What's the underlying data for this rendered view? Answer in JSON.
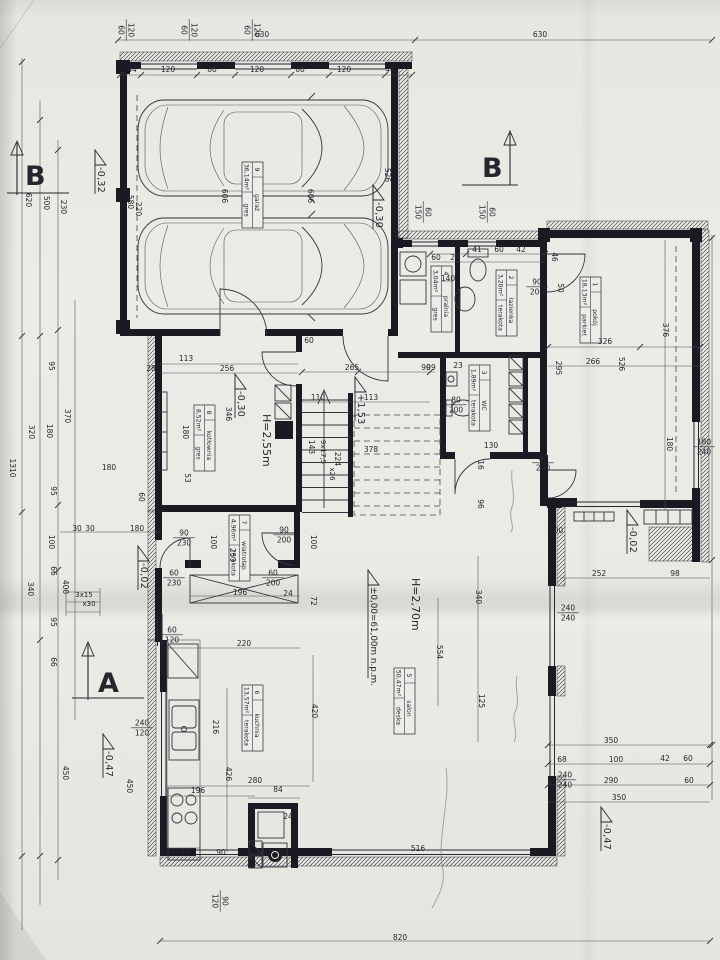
{
  "palette": {
    "paper": "#eae9e4",
    "ink": "#22222a",
    "thin_line": "#4c4c55"
  },
  "plan": {
    "heights": [
      [
        "H=2,55m",
        263,
        414
      ],
      [
        "H=2,70m",
        412,
        578
      ]
    ],
    "levels": [
      [
        "-0,32",
        96,
        150
      ],
      [
        "-0,30",
        374,
        185
      ],
      [
        "-0,30",
        236,
        374
      ],
      [
        "+1,53",
        356,
        377
      ],
      [
        "±0,00=61,00m n.p.m.",
        369,
        570
      ],
      [
        "-0,02",
        628,
        510
      ],
      [
        "-0,02",
        139,
        546
      ],
      [
        "-0,47",
        602,
        807
      ],
      [
        "-0,47",
        104,
        734
      ]
    ],
    "sections": [
      {
        "letter": "B",
        "x": 25,
        "y": 185,
        "v": 0
      },
      {
        "letter": "B",
        "x": 482,
        "y": 177,
        "v": 1
      },
      {
        "letter": "A",
        "x": 98,
        "y": 692,
        "v": 2
      }
    ],
    "stair_notes": [
      [
        "9x17,5",
        321,
        452,
        1
      ],
      [
        "x26",
        330,
        474,
        1
      ],
      [
        "3x15",
        84,
        597,
        0
      ],
      [
        "x30",
        89,
        606,
        0
      ]
    ]
  },
  "rooms": [
    {
      "no": "1",
      "name": "pokój",
      "area": "18,13m²",
      "floor": "parkiet",
      "x": 601,
      "y": 277
    },
    {
      "no": "2",
      "name": "łazienka",
      "area": "3,20m²",
      "floor": "terakota",
      "x": 517,
      "y": 270
    },
    {
      "no": "3",
      "name": "WC",
      "area": "1,89m²",
      "floor": "terakota",
      "x": 490,
      "y": 365
    },
    {
      "no": "4",
      "name": "pralnia",
      "area": "3,04m²",
      "floor": "gres",
      "x": 452,
      "y": 266
    },
    {
      "no": "5",
      "name": "salon",
      "area": "50,47m²",
      "floor": "deska",
      "x": 415,
      "y": 668
    },
    {
      "no": "6",
      "name": "kuchnia",
      "area": "13,57m²",
      "floor": "terakota",
      "x": 263,
      "y": 685
    },
    {
      "no": "7",
      "name": "wiatrołap",
      "area": "4,96m²",
      "floor": "terakota",
      "x": 250,
      "y": 515
    },
    {
      "no": "8",
      "name": "kotłownia",
      "area": "8,52m²",
      "floor": "gres",
      "x": 215,
      "y": 405
    },
    {
      "no": "9",
      "name": "garaż",
      "area": "36,14m²",
      "floor": "gres",
      "x": 263,
      "y": 162
    }
  ],
  "opening_labels": [
    [
      "120/60",
      127,
      30,
      1
    ],
    [
      "120/60",
      190,
      30,
      1
    ],
    [
      "120/60",
      253,
      30,
      1
    ],
    [
      "60/150",
      424,
      212,
      1
    ],
    [
      "60/150",
      488,
      212,
      1
    ],
    [
      "180/240",
      704,
      446,
      0
    ],
    [
      "240/240",
      568,
      612,
      0
    ],
    [
      "240/240",
      565,
      779,
      0
    ],
    [
      "240/120",
      142,
      727,
      0
    ],
    [
      "60/120",
      172,
      634,
      0
    ],
    [
      "90/120",
      221,
      901,
      1
    ],
    [
      "90/200",
      537,
      286,
      0
    ],
    [
      "90/230",
      184,
      537,
      0
    ],
    [
      "90/200",
      284,
      534,
      0
    ],
    [
      "60/230",
      174,
      577,
      0
    ],
    [
      "60/200",
      273,
      577,
      0
    ],
    [
      "80/200",
      456,
      404,
      0
    ],
    [
      "80/200",
      543,
      462,
      0
    ]
  ],
  "dims": [
    [
      "630",
      262,
      37,
      0
    ],
    [
      "630",
      540,
      37,
      0
    ],
    [
      "44",
      132,
      72,
      0
    ],
    [
      "120",
      168,
      72,
      0
    ],
    [
      "80",
      212,
      72,
      0
    ],
    [
      "120",
      257,
      72,
      0
    ],
    [
      "80",
      300,
      72,
      0
    ],
    [
      "120",
      344,
      72,
      0
    ],
    [
      "44",
      390,
      72,
      0
    ],
    [
      "606",
      222,
      196,
      1
    ],
    [
      "606",
      308,
      196,
      1
    ],
    [
      "580",
      128,
      202,
      1
    ],
    [
      "220",
      136,
      209,
      1
    ],
    [
      "526",
      385,
      175,
      1
    ],
    [
      "620",
      26,
      200,
      1
    ],
    [
      "500",
      44,
      203,
      1
    ],
    [
      "230",
      61,
      207,
      1
    ],
    [
      "95",
      49,
      366,
      1
    ],
    [
      "370",
      65,
      416,
      1
    ],
    [
      "320",
      29,
      432,
      1
    ],
    [
      "1310",
      10,
      468,
      1
    ],
    [
      "180",
      47,
      431,
      1
    ],
    [
      "95",
      51,
      491,
      1
    ],
    [
      "100",
      49,
      542,
      1
    ],
    [
      "66",
      51,
      571,
      1
    ],
    [
      "340",
      28,
      589,
      1
    ],
    [
      "400",
      63,
      587,
      1
    ],
    [
      "95",
      51,
      622,
      1
    ],
    [
      "66",
      51,
      662,
      1
    ],
    [
      "450",
      63,
      773,
      1
    ],
    [
      "450",
      127,
      786,
      1
    ],
    [
      "41",
      477,
      252,
      0
    ],
    [
      "60",
      499,
      252,
      0
    ],
    [
      "42",
      521,
      252,
      0
    ],
    [
      "60",
      436,
      260,
      0
    ],
    [
      "28",
      455,
      260,
      0
    ],
    [
      "140",
      448,
      281,
      0
    ],
    [
      "46",
      552,
      257,
      1
    ],
    [
      "50",
      558,
      288,
      1
    ],
    [
      "326",
      605,
      344,
      0
    ],
    [
      "266",
      593,
      364,
      0
    ],
    [
      "376",
      663,
      330,
      1
    ],
    [
      "526",
      619,
      364,
      1
    ],
    [
      "295",
      556,
      368,
      1
    ],
    [
      "180",
      667,
      444,
      1
    ],
    [
      "252",
      599,
      576,
      0
    ],
    [
      "98",
      675,
      576,
      0
    ],
    [
      "350",
      611,
      743,
      0
    ],
    [
      "68",
      562,
      762,
      0
    ],
    [
      "100",
      616,
      762,
      0
    ],
    [
      "42",
      665,
      761,
      0
    ],
    [
      "60",
      688,
      761,
      0
    ],
    [
      "290",
      611,
      783,
      0
    ],
    [
      "60",
      689,
      783,
      0
    ],
    [
      "350",
      619,
      800,
      0
    ],
    [
      "265",
      352,
      370,
      0
    ],
    [
      "90",
      426,
      370,
      0
    ],
    [
      "110",
      318,
      400,
      0
    ],
    [
      "113",
      371,
      400,
      0
    ],
    [
      "143",
      309,
      447,
      1
    ],
    [
      "224",
      335,
      459,
      1
    ],
    [
      "99",
      431,
      370,
      0
    ],
    [
      "23",
      458,
      368,
      0
    ],
    [
      "130",
      491,
      448,
      0
    ],
    [
      "16",
      478,
      465,
      1
    ],
    [
      "96",
      478,
      504,
      1
    ],
    [
      "100",
      556,
      533,
      0
    ],
    [
      "378",
      371,
      452,
      0
    ],
    [
      "113",
      186,
      361,
      0
    ],
    [
      "256",
      227,
      371,
      0
    ],
    [
      "346",
      226,
      414,
      1
    ],
    [
      "180",
      183,
      432,
      1
    ],
    [
      "53",
      185,
      478,
      1
    ],
    [
      "28",
      151,
      371,
      0
    ],
    [
      "60",
      309,
      343,
      0
    ],
    [
      "100",
      211,
      542,
      1
    ],
    [
      "253",
      230,
      555,
      1
    ],
    [
      "196",
      240,
      595,
      0
    ],
    [
      "24",
      288,
      596,
      0
    ],
    [
      "100",
      311,
      542,
      1
    ],
    [
      "72",
      311,
      601,
      1
    ],
    [
      "30",
      77,
      531,
      0
    ],
    [
      "30",
      90,
      531,
      0
    ],
    [
      "180",
      137,
      531,
      0
    ],
    [
      "60",
      139,
      497,
      1
    ],
    [
      "180",
      109,
      470,
      0
    ],
    [
      "220",
      244,
      646,
      0
    ],
    [
      "216",
      213,
      727,
      1
    ],
    [
      "426",
      226,
      774,
      1
    ],
    [
      "280",
      255,
      783,
      0
    ],
    [
      "196",
      198,
      793,
      0
    ],
    [
      "84",
      278,
      792,
      0
    ],
    [
      "24",
      288,
      819,
      0
    ],
    [
      "70",
      185,
      855,
      0
    ],
    [
      "90",
      221,
      855,
      0
    ],
    [
      "516",
      418,
      851,
      0
    ],
    [
      "340",
      476,
      597,
      1
    ],
    [
      "554",
      437,
      652,
      1
    ],
    [
      "125",
      479,
      701,
      1
    ],
    [
      "420",
      312,
      711,
      1
    ],
    [
      "820",
      400,
      940,
      0
    ]
  ]
}
